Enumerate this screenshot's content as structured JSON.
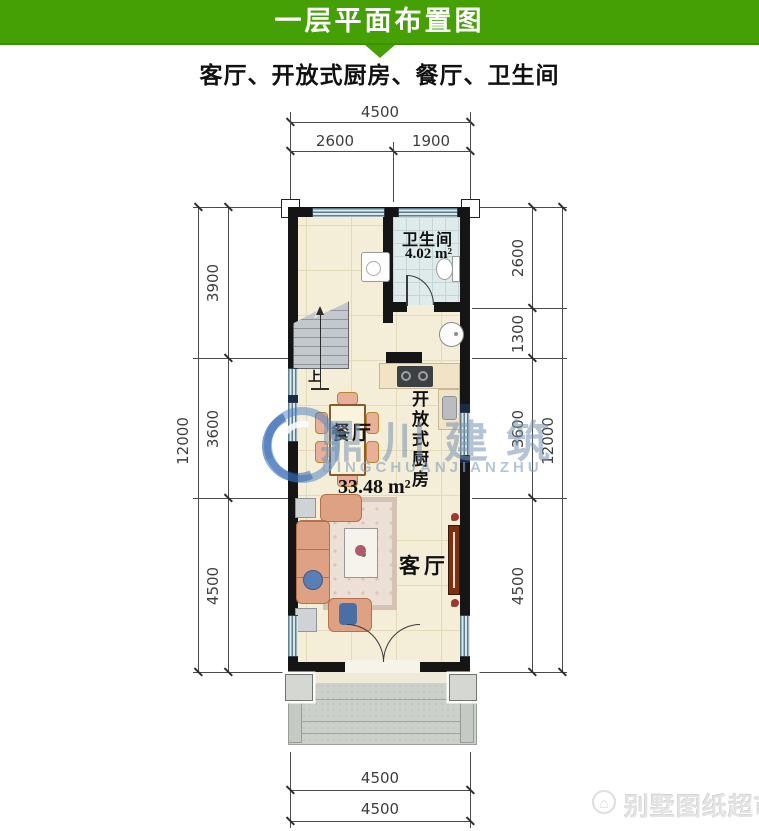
{
  "header": {
    "title": "一层平面布置图"
  },
  "subtitle": "客厅、开放式厨房、餐厅、卫生间",
  "plan": {
    "bathroom_label": "卫生间",
    "bathroom_area": "4.02 m²",
    "kitchen_label": "开放式厨房",
    "dining_label": "餐厅",
    "living_label": "客厅",
    "total_area": "33.48 m²",
    "stairs_up": "上"
  },
  "dimensions": {
    "top": {
      "total": "4500",
      "segments": [
        "2600",
        "1900"
      ]
    },
    "left": {
      "total": "12000",
      "segments": [
        "3900",
        "3600",
        "4500"
      ]
    },
    "right": {
      "total": "12000",
      "segments": [
        "2600",
        "1300",
        "3600",
        "4500"
      ]
    },
    "bottom": {
      "lines": [
        "4500",
        "4500"
      ]
    }
  },
  "watermark": {
    "cn": "鼎川建筑",
    "en": "DINGCHUANJIANZHU"
  },
  "brand": {
    "text": "别墅图纸超市",
    "icon": "⌂"
  },
  "colors": {
    "header_green": "#44a005",
    "wall_black": "#151515",
    "floor_cream": "#f4edd8",
    "bathroom_blue": "#dfeaeb",
    "window_blue": "#d9e8ea",
    "counter_tan": "#f1e3c5",
    "watermark_blue": "#4a7dc0"
  }
}
